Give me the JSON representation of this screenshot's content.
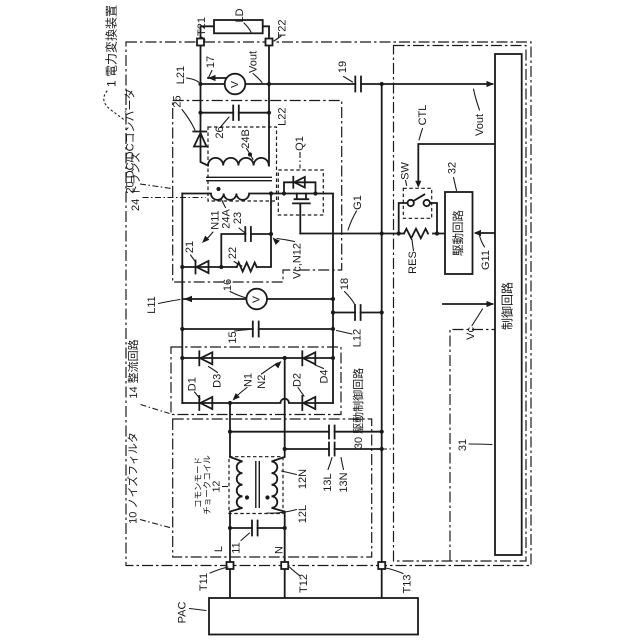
{
  "colors": {
    "line": "#1a1a1a",
    "background": "#ffffff"
  },
  "labels": {
    "device": "1 電力変換装置",
    "dcdc": "20 DC/DCコンバータ",
    "trans": "24 トランス",
    "rectifier": "14 整流回路",
    "noise": "10 ノイズフィルタ",
    "drivectl": "30 駆動制御回路",
    "cm1": "コモンモード",
    "cm2": "チョークコイル",
    "choke_num": "12",
    "ld": "LD",
    "t21": "T21",
    "t22": "T22",
    "t11": "T11",
    "t12": "T12",
    "t13": "T13",
    "l21": "L21",
    "l22": "L22",
    "l11": "L11",
    "l12": "L12",
    "n17": "17",
    "vout_top": "Vout",
    "n25": "25",
    "n26": "26",
    "w24b": "24B",
    "w24a": "24A",
    "n23": "23",
    "n11node": "N11",
    "n21": "21",
    "n22": "22",
    "vcn12": "Vc,N12",
    "q1": "Q1",
    "g1": "G1",
    "n19": "19",
    "ctl": "CTL",
    "sw": "SW",
    "res": "RES",
    "n32": "32",
    "g11": "G11",
    "vout_right": "Vout",
    "vc_right": "Vc",
    "n31": "31",
    "n16": "16",
    "n15": "15",
    "n18": "18",
    "d1": "D1",
    "d2": "D2",
    "d3": "D3",
    "d4": "D4",
    "n1node": "N1",
    "n2node": "N2",
    "c13l": "13L",
    "c13n": "13N",
    "w12l": "12L",
    "w12n": "12N",
    "c11": "11",
    "line_l": "L",
    "line_n": "N",
    "pac": "PAC",
    "drive_box": "駆動回路",
    "ctrl_box": "制御回路",
    "voltmeter_v": "V"
  }
}
